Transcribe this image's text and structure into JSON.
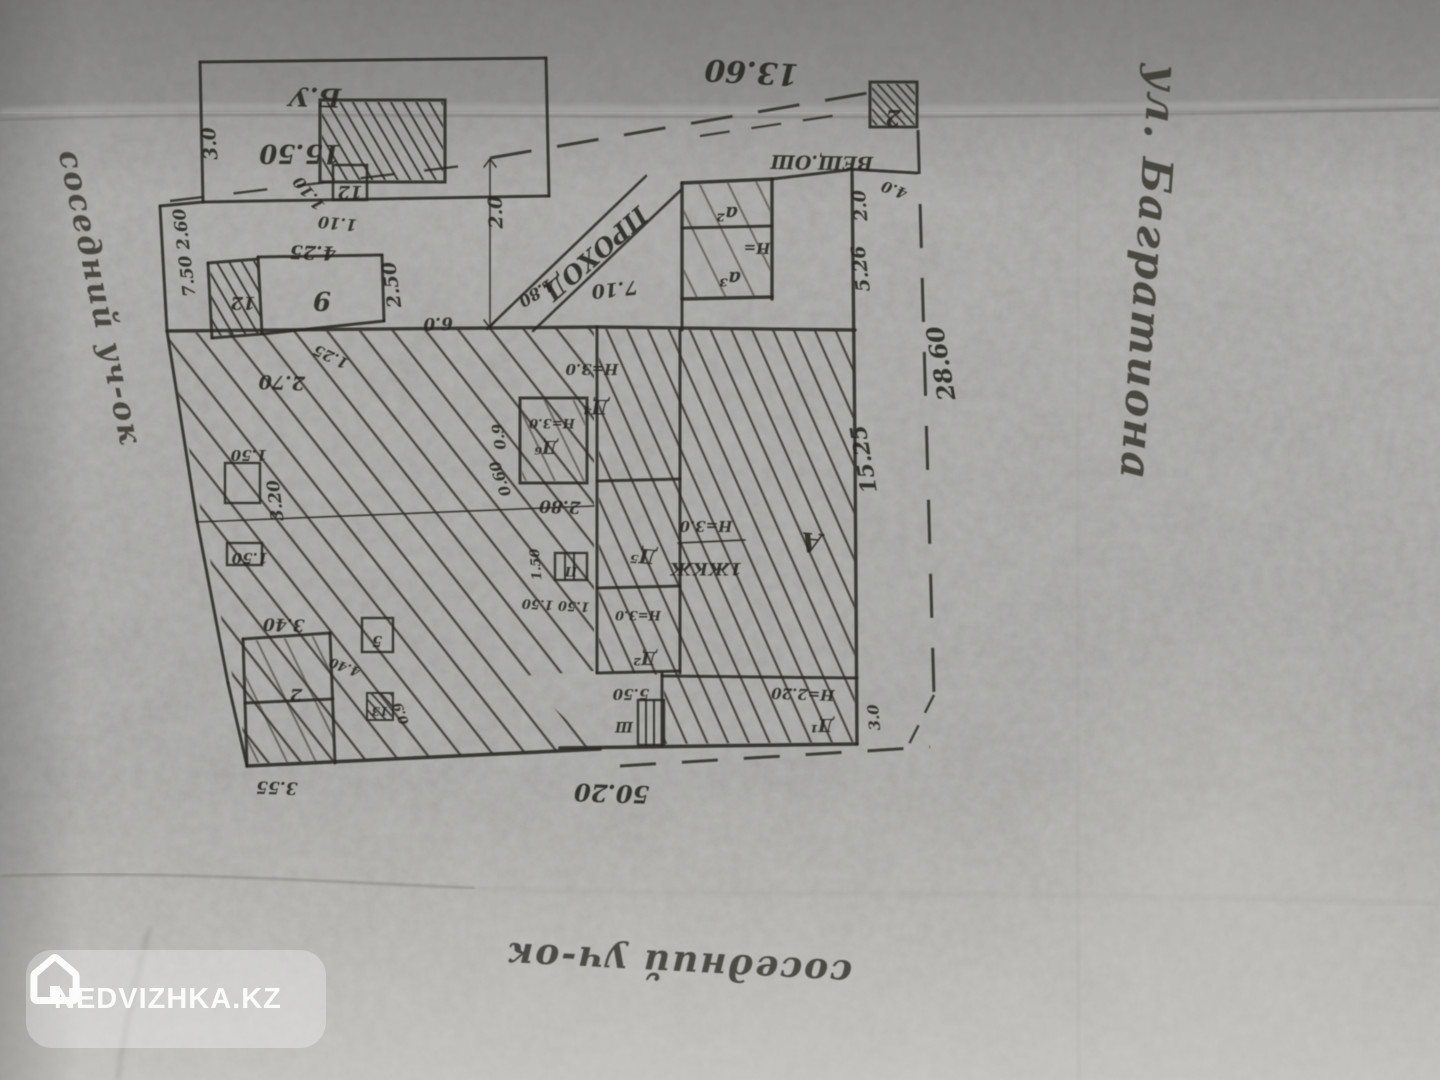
{
  "watermark": {
    "label": "NEDVIZHKA.KZ",
    "icon": "house-icon"
  },
  "colors": {
    "paper": "#9b9a97",
    "ink": "#2b2824",
    "label_ink": "#262420",
    "watermark_bg": "rgba(255,255,255,0.30)",
    "watermark_text": "#fcfcfc"
  },
  "plan": {
    "type": "hand-drawn cadastral site plan (photocopy, drawn rotated 180°)",
    "street_label": "ул. Багратиона",
    "neighbor_left_label": "соседний уч-ок",
    "neighbor_bottom_label": "соседний уч-ок",
    "passage_label": "ПРОХОД",
    "regions": [
      {
        "name": "yard-hatch-region",
        "pattern": "pA",
        "pts": "167,333 594,328 594,671 520,676 598,749 249,764"
      },
      {
        "name": "main-house-hatch-region",
        "pattern": "pB",
        "pts": "599,329 853,331 855,742 664,744 664,675 599,671"
      },
      {
        "name": "shed-box-hatch",
        "pattern": "pC",
        "pts": "322,102 443,102 443,180 322,180"
      },
      {
        "name": "room-12-hatch",
        "pattern": "pC",
        "pts": "210,264 258,260 261,333 213,336"
      },
      {
        "name": "boundary-box-2-hatch",
        "pattern": "pD",
        "pts": "872,84 915,84 915,125 872,125"
      },
      {
        "name": "room-d6-hatch",
        "pattern": "pE",
        "pts": "522,400 585,400 585,481 522,481"
      },
      {
        "name": "annex-a-hatch",
        "pattern": "pE",
        "pts": "684,185 770,181 770,296 684,297"
      },
      {
        "name": "bottom-left-block-hatch",
        "pattern": "pE",
        "pts": "245,641 329,635 334,761 248,763"
      },
      {
        "name": "box-13-hatch",
        "pattern": "pD",
        "pts": "368,694 392,694 392,719 368,719"
      }
    ],
    "walls": [
      {
        "x1": 200,
        "y1": 62,
        "x2": 546,
        "y2": 58
      },
      {
        "x1": 546,
        "y1": 58,
        "x2": 549,
        "y2": 196
      },
      {
        "x1": 549,
        "y1": 196,
        "x2": 203,
        "y2": 202
      },
      {
        "x1": 203,
        "y1": 202,
        "x2": 200,
        "y2": 62
      },
      {
        "x1": 160,
        "y1": 206,
        "x2": 203,
        "y2": 202
      },
      {
        "x1": 160,
        "y1": 206,
        "x2": 167,
        "y2": 331
      },
      {
        "x1": 167,
        "y1": 331,
        "x2": 197,
        "y2": 521
      },
      {
        "x1": 197,
        "y1": 521,
        "x2": 228,
        "y2": 683
      },
      {
        "x1": 228,
        "y1": 683,
        "x2": 247,
        "y2": 766
      },
      {
        "x1": 167,
        "y1": 331,
        "x2": 490,
        "y2": 328,
        "w": 3.4
      },
      {
        "x1": 490,
        "y1": 328,
        "x2": 597,
        "y2": 327,
        "w": 3.4
      },
      {
        "x1": 597,
        "y1": 327,
        "x2": 855,
        "y2": 330,
        "w": 3.4
      },
      {
        "x1": 597,
        "y1": 327,
        "x2": 597,
        "y2": 673
      },
      {
        "x1": 680,
        "y1": 330,
        "x2": 680,
        "y2": 673
      },
      {
        "x1": 597,
        "y1": 481,
        "x2": 680,
        "y2": 479
      },
      {
        "x1": 597,
        "y1": 588,
        "x2": 680,
        "y2": 586
      },
      {
        "x1": 597,
        "y1": 673,
        "x2": 680,
        "y2": 671
      },
      {
        "x1": 662,
        "y1": 673,
        "x2": 662,
        "y2": 746
      },
      {
        "x1": 662,
        "y1": 676,
        "x2": 857,
        "y2": 678
      },
      {
        "x1": 560,
        "y1": 748,
        "x2": 857,
        "y2": 744,
        "w": 3.6
      },
      {
        "x1": 247,
        "y1": 766,
        "x2": 600,
        "y2": 749,
        "w": 3.6
      },
      {
        "x1": 852,
        "y1": 170,
        "x2": 855,
        "y2": 450,
        "w": 3.4
      },
      {
        "x1": 855,
        "y1": 450,
        "x2": 857,
        "y2": 744,
        "w": 3.4
      },
      {
        "x1": 848,
        "y1": 169,
        "x2": 917,
        "y2": 173
      },
      {
        "x1": 772,
        "y1": 179,
        "x2": 848,
        "y2": 170
      },
      {
        "x1": 682,
        "y1": 183,
        "x2": 772,
        "y2": 179,
        "w": 3.4
      },
      {
        "x1": 682,
        "y1": 183,
        "x2": 682,
        "y2": 299,
        "w": 3.4
      },
      {
        "x1": 772,
        "y1": 179,
        "x2": 772,
        "y2": 299,
        "w": 3.4
      },
      {
        "x1": 682,
        "y1": 228,
        "x2": 772,
        "y2": 226
      },
      {
        "x1": 682,
        "y1": 299,
        "x2": 772,
        "y2": 297,
        "w": 3.4
      },
      {
        "x1": 682,
        "y1": 299,
        "x2": 682,
        "y2": 330
      },
      {
        "x1": 490,
        "y1": 160,
        "x2": 490,
        "y2": 328,
        "w": 1.6
      },
      {
        "x1": 484,
        "y1": 167,
        "x2": 490,
        "y2": 159,
        "w": 1.6
      },
      {
        "x1": 496,
        "y1": 167,
        "x2": 490,
        "y2": 159,
        "w": 1.6
      },
      {
        "x1": 484,
        "y1": 320,
        "x2": 490,
        "y2": 328,
        "w": 1.6
      },
      {
        "x1": 496,
        "y1": 320,
        "x2": 490,
        "y2": 328,
        "w": 1.6
      },
      {
        "x1": 487,
        "y1": 329,
        "x2": 646,
        "y2": 176,
        "w": 2.6
      },
      {
        "x1": 533,
        "y1": 331,
        "x2": 681,
        "y2": 190,
        "w": 2.6
      },
      {
        "x1": 208,
        "y1": 263,
        "x2": 258,
        "y2": 259
      },
      {
        "x1": 212,
        "y1": 338,
        "x2": 262,
        "y2": 334
      },
      {
        "x1": 208,
        "y1": 263,
        "x2": 212,
        "y2": 338
      },
      {
        "x1": 258,
        "y1": 257,
        "x2": 382,
        "y2": 255
      },
      {
        "x1": 382,
        "y1": 255,
        "x2": 384,
        "y2": 321
      },
      {
        "x1": 384,
        "y1": 321,
        "x2": 262,
        "y2": 334
      },
      {
        "x1": 258,
        "y1": 257,
        "x2": 262,
        "y2": 334
      },
      {
        "x1": 197,
        "y1": 522,
        "x2": 594,
        "y2": 506,
        "w": 1.6
      },
      {
        "x1": 243,
        "y1": 639,
        "x2": 330,
        "y2": 633
      },
      {
        "x1": 330,
        "y1": 633,
        "x2": 335,
        "y2": 763
      },
      {
        "x1": 243,
        "y1": 639,
        "x2": 247,
        "y2": 766
      },
      {
        "x1": 245,
        "y1": 703,
        "x2": 333,
        "y2": 699
      },
      {
        "x1": 565,
        "y1": 553,
        "x2": 565,
        "y2": 580,
        "w": 2
      },
      {
        "x1": 574,
        "y1": 553,
        "x2": 574,
        "y2": 580,
        "w": 2
      },
      {
        "x1": 646,
        "y1": 700,
        "x2": 646,
        "y2": 745,
        "w": 2
      },
      {
        "x1": 654,
        "y1": 700,
        "x2": 654,
        "y2": 745,
        "w": 2
      },
      {
        "x1": 678,
        "y1": 543,
        "x2": 745,
        "y2": 540,
        "w": 1.8
      }
    ],
    "boxes": [
      {
        "name": "shed-hatched-box",
        "x": 320,
        "y": 100,
        "w": 125,
        "h": 82,
        "s": 3.2
      },
      {
        "name": "box-12",
        "x": 333,
        "y": 165,
        "w": 34,
        "h": 35,
        "s": 2.6
      },
      {
        "name": "boundary-box-2",
        "x": 870,
        "y": 82,
        "w": 47,
        "h": 45,
        "s": 3
      },
      {
        "name": "room-d6-box",
        "x": 520,
        "y": 398,
        "w": 67,
        "h": 85,
        "s": 3
      },
      {
        "name": "box-p",
        "x": 555,
        "y": 553,
        "w": 32,
        "h": 27,
        "s": 2.4
      },
      {
        "name": "box-sh",
        "x": 638,
        "y": 700,
        "w": 26,
        "h": 45,
        "s": 2.4
      },
      {
        "name": "box-5",
        "x": 362,
        "y": 618,
        "w": 31,
        "h": 34,
        "s": 2.4
      },
      {
        "name": "box-13",
        "x": 367,
        "y": 693,
        "w": 26,
        "h": 27,
        "s": 2
      },
      {
        "name": "left-box-a",
        "x": 225,
        "y": 463,
        "w": 35,
        "h": 40,
        "s": 2.4
      },
      {
        "name": "left-box-b",
        "x": 227,
        "y": 543,
        "w": 35,
        "h": 22,
        "s": 2.4
      }
    ],
    "dashes": [
      {
        "name": "top-boundary-left",
        "x1": 170,
        "y1": 201,
        "x2": 487,
        "y2": 163,
        "da": "34 30",
        "w": 2.4
      },
      {
        "name": "top-boundary",
        "x1": 490,
        "y1": 158,
        "x2": 868,
        "y2": 93,
        "da": "42 26",
        "w": 3
      },
      {
        "name": "top-inner-dashes",
        "x1": 700,
        "y1": 136,
        "x2": 845,
        "y2": 114,
        "da": "30 22",
        "w": 2.2
      },
      {
        "name": "right-boundary",
        "x1": 918,
        "y1": 130,
        "x2": 934,
        "y2": 695,
        "da": "44 30",
        "w": 3
      },
      {
        "name": "bottom-boundary",
        "x1": 620,
        "y1": 766,
        "x2": 930,
        "y2": 747,
        "da": "36 26",
        "w": 3
      },
      {
        "name": "bottom-right-corner",
        "x1": 934,
        "y1": 695,
        "x2": 905,
        "y2": 752,
        "da": "20 14",
        "w": 2.4
      }
    ],
    "labels": [
      {
        "text": "13.60",
        "x": 752,
        "y": 62,
        "r": 183,
        "s": 30
      },
      {
        "text": "2",
        "x": 893,
        "y": 110,
        "r": 180,
        "s": 22
      },
      {
        "text": "Б.У",
        "x": 315,
        "y": 88,
        "r": 182,
        "s": 26
      },
      {
        "text": "15.50",
        "x": 300,
        "y": 145,
        "r": 180,
        "s": 26
      },
      {
        "text": "3.0",
        "x": 216,
        "y": 143,
        "r": 265,
        "s": 19
      },
      {
        "text": "12",
        "x": 350,
        "y": 186,
        "r": 180,
        "s": 18
      },
      {
        "text": "1.10",
        "x": 313,
        "y": 190,
        "r": 230,
        "s": 16
      },
      {
        "text": "1.10",
        "x": 338,
        "y": 218,
        "r": 185,
        "s": 16
      },
      {
        "text": "4.25",
        "x": 313,
        "y": 246,
        "r": 182,
        "s": 19
      },
      {
        "text": "2.0",
        "x": 502,
        "y": 212,
        "r": 268,
        "s": 19
      },
      {
        "text": "9",
        "x": 322,
        "y": 292,
        "r": 180,
        "s": 26
      },
      {
        "text": "12",
        "x": 243,
        "y": 297,
        "r": 180,
        "s": 18
      },
      {
        "text": "2.50",
        "x": 398,
        "y": 284,
        "r": 262,
        "s": 19
      },
      {
        "text": "6.0",
        "x": 438,
        "y": 318,
        "r": 178,
        "s": 17
      },
      {
        "text": "ПРОХОД",
        "x": 590,
        "y": 247,
        "r": 139,
        "s": 25
      },
      {
        "text": "4.80",
        "x": 534,
        "y": 288,
        "r": 148,
        "s": 16
      },
      {
        "text": "7.10",
        "x": 614,
        "y": 283,
        "r": 174,
        "s": 19
      },
      {
        "text": "ВЕЩ.ОШ",
        "x": 822,
        "y": 156,
        "r": 181,
        "s": 19
      },
      {
        "text": "а²",
        "x": 727,
        "y": 207,
        "r": 180,
        "s": 20
      },
      {
        "text": "Н=",
        "x": 757,
        "y": 243,
        "r": 180,
        "s": 15
      },
      {
        "text": "а³",
        "x": 730,
        "y": 272,
        "r": 180,
        "s": 20
      },
      {
        "text": "2.0",
        "x": 866,
        "y": 205,
        "r": 265,
        "s": 18
      },
      {
        "text": "5.26",
        "x": 867,
        "y": 268,
        "r": 263,
        "s": 19
      },
      {
        "text": "4.0",
        "x": 896,
        "y": 185,
        "r": 200,
        "s": 15
      },
      {
        "text": "28.60",
        "x": 949,
        "y": 362,
        "r": 260,
        "s": 24
      },
      {
        "text": "15.25",
        "x": 871,
        "y": 458,
        "r": 260,
        "s": 22
      },
      {
        "text": "2.70",
        "x": 282,
        "y": 376,
        "r": 182,
        "s": 19
      },
      {
        "text": "1.25",
        "x": 333,
        "y": 352,
        "r": 205,
        "s": 15
      },
      {
        "text": "1.50",
        "x": 249,
        "y": 450,
        "r": 180,
        "s": 15
      },
      {
        "text": "3.20",
        "x": 281,
        "y": 500,
        "r": 263,
        "s": 17
      },
      {
        "text": "1.50",
        "x": 250,
        "y": 553,
        "r": 180,
        "s": 15
      },
      {
        "text": "0.9",
        "x": 504,
        "y": 436,
        "r": 262,
        "s": 15
      },
      {
        "text": "0.60",
        "x": 505,
        "y": 477,
        "r": 250,
        "s": 15
      },
      {
        "text": "Д⁶",
        "x": 546,
        "y": 441,
        "r": 180,
        "s": 18
      },
      {
        "text": "Н=3.0",
        "x": 552,
        "y": 419,
        "r": 180,
        "s": 13
      },
      {
        "text": "Н=3.0",
        "x": 592,
        "y": 364,
        "r": 180,
        "s": 15
      },
      {
        "text": "Д⁴",
        "x": 596,
        "y": 400,
        "r": 180,
        "s": 20
      },
      {
        "text": "2.80",
        "x": 560,
        "y": 501,
        "r": 182,
        "s": 17
      },
      {
        "text": "1.50",
        "x": 540,
        "y": 564,
        "r": 265,
        "s": 13
      },
      {
        "text": "П",
        "x": 571,
        "y": 567,
        "r": 180,
        "s": 13
      },
      {
        "text": "1.50 1.50",
        "x": 556,
        "y": 601,
        "r": 183,
        "s": 13
      },
      {
        "text": "Д⁵",
        "x": 644,
        "y": 549,
        "r": 185,
        "s": 20
      },
      {
        "text": "Н=3.0",
        "x": 706,
        "y": 521,
        "r": 180,
        "s": 15
      },
      {
        "text": "1ЖКЖ",
        "x": 706,
        "y": 563,
        "r": 180,
        "s": 17
      },
      {
        "text": "А",
        "x": 812,
        "y": 533,
        "r": 185,
        "s": 27
      },
      {
        "text": "Н=3.0",
        "x": 638,
        "y": 611,
        "r": 180,
        "s": 13
      },
      {
        "text": "Д²",
        "x": 645,
        "y": 652,
        "r": 180,
        "s": 18
      },
      {
        "text": "5.50",
        "x": 631,
        "y": 689,
        "r": 180,
        "s": 15
      },
      {
        "text": "Ш",
        "x": 624,
        "y": 722,
        "r": 180,
        "s": 14
      },
      {
        "text": "Н=2.20",
        "x": 803,
        "y": 689,
        "r": 182,
        "s": 15
      },
      {
        "text": "Д¹",
        "x": 822,
        "y": 719,
        "r": 180,
        "s": 18
      },
      {
        "text": "3.0",
        "x": 879,
        "y": 717,
        "r": 265,
        "s": 15
      },
      {
        "text": "50.20",
        "x": 612,
        "y": 785,
        "r": 182,
        "s": 24
      },
      {
        "text": "3.40",
        "x": 284,
        "y": 619,
        "r": 182,
        "s": 17
      },
      {
        "text": "2",
        "x": 296,
        "y": 689,
        "r": 180,
        "s": 18
      },
      {
        "text": "3.55",
        "x": 277,
        "y": 782,
        "r": 182,
        "s": 17
      },
      {
        "text": "5",
        "x": 377,
        "y": 636,
        "r": 180,
        "s": 15
      },
      {
        "text": "4.40",
        "x": 346,
        "y": 663,
        "r": 200,
        "s": 13
      },
      {
        "text": "13",
        "x": 380,
        "y": 707,
        "r": 180,
        "s": 12
      },
      {
        "text": "0.9",
        "x": 405,
        "y": 712,
        "r": 250,
        "s": 13
      },
      {
        "text": "7.50 2.60",
        "x": 190,
        "y": 252,
        "r": 263,
        "s": 17
      },
      {
        "text": "соседний уч-ок",
        "x": 90,
        "y": 300,
        "r": 78,
        "s": 31,
        "cls": "hand",
        "name": "neighbor-left-label"
      },
      {
        "text": "ул. Багратиона",
        "x": 1135,
        "y": 272,
        "r": 94,
        "s": 42,
        "cls": "hand",
        "name": "street-name-label"
      },
      {
        "text": "соседний уч-ок",
        "x": 680,
        "y": 952,
        "r": 183,
        "s": 36,
        "cls": "hand",
        "name": "neighbor-bottom-label"
      }
    ]
  }
}
